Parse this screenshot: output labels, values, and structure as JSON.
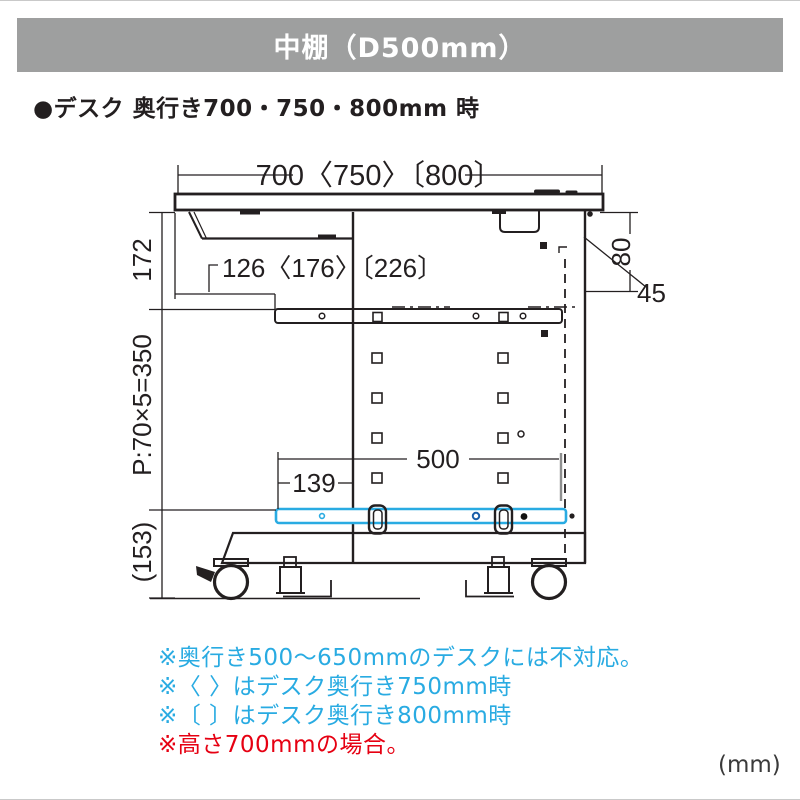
{
  "header": {
    "title": "中棚（D500mm）",
    "bg_color": "#9e9f9f",
    "text_color": "#ffffff"
  },
  "section": {
    "heading": "●デスク 奥行き700・750・800mm 時"
  },
  "diagram": {
    "dimensions": {
      "top_width": "700〈750〉〔800〕",
      "left_upper": "172",
      "tray_offset": "126〈176〉〔226〕",
      "right_top": "80",
      "right_overhang": "45",
      "pitch": "P:70×5=350",
      "shelf_depth": "500",
      "shelf_offset": "139",
      "base_height": "(153)"
    },
    "colors": {
      "line": "#231f20",
      "shelf_highlight": "#29abe2"
    }
  },
  "notes": {
    "items": [
      {
        "text": "※奥行き500〜650mmのデスクには不対応。",
        "color": "#29abe2"
      },
      {
        "text": "※〈 〉はデスク奥行き750mm時",
        "color": "#29abe2"
      },
      {
        "text": "※〔 〕はデスク奥行き800mm時",
        "color": "#29abe2"
      },
      {
        "text": "※高さ700mmの場合。",
        "color": "#e60012"
      }
    ]
  },
  "footer": {
    "unit_label": "(mm)"
  }
}
